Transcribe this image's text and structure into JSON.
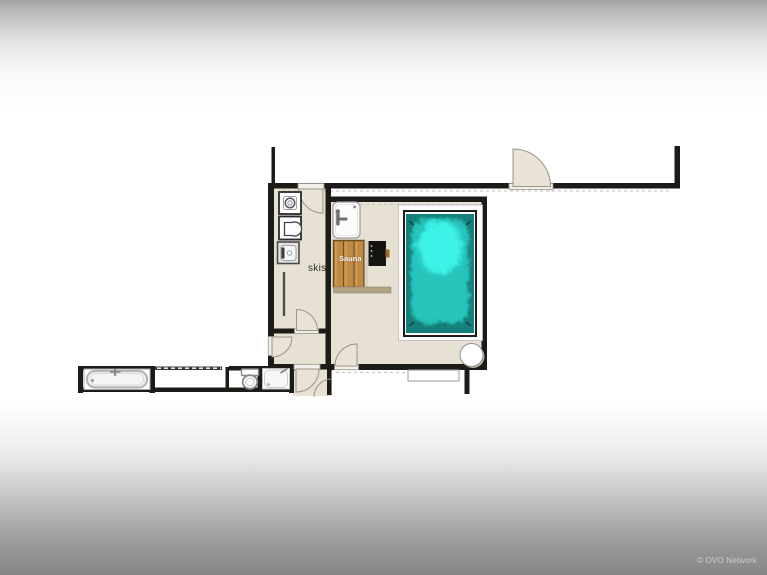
{
  "page": {
    "type": "floor-plan-screenshot",
    "background": {
      "top": "#a2a2a2",
      "middle": "#ffffff",
      "bottom": "#8a8a8a"
    }
  },
  "watermark": {
    "text": "© OVO Network",
    "color": "rgba(255,255,255,0.55)"
  },
  "plan": {
    "labels": {
      "ski_room": "skis",
      "sauna": "Sauna"
    },
    "colors": {
      "wall": "#1d1b18",
      "floor": "#e7e1d3",
      "door_leaf": "#e9e3d5",
      "threshold": "#f2efe8",
      "pool_deep": "#15807a",
      "pool_mid": "#28c4ba",
      "pool_shallow": "#3df2e6",
      "pool_deck": "#fdfdfc",
      "sauna_wood": "#c08a45",
      "sauna_bench": "#b3a485",
      "stove": "#161412",
      "fixture_outline": "#9a9a9a"
    },
    "fixtures": [
      "swimming-pool",
      "sauna-benches",
      "sauna-stove",
      "shower-tray-sink",
      "washing-machine",
      "laundry-sink",
      "dryer",
      "ski-rack",
      "bathtub",
      "toilet",
      "shower",
      "round-table",
      "window-ledge"
    ],
    "door_count": 7
  }
}
